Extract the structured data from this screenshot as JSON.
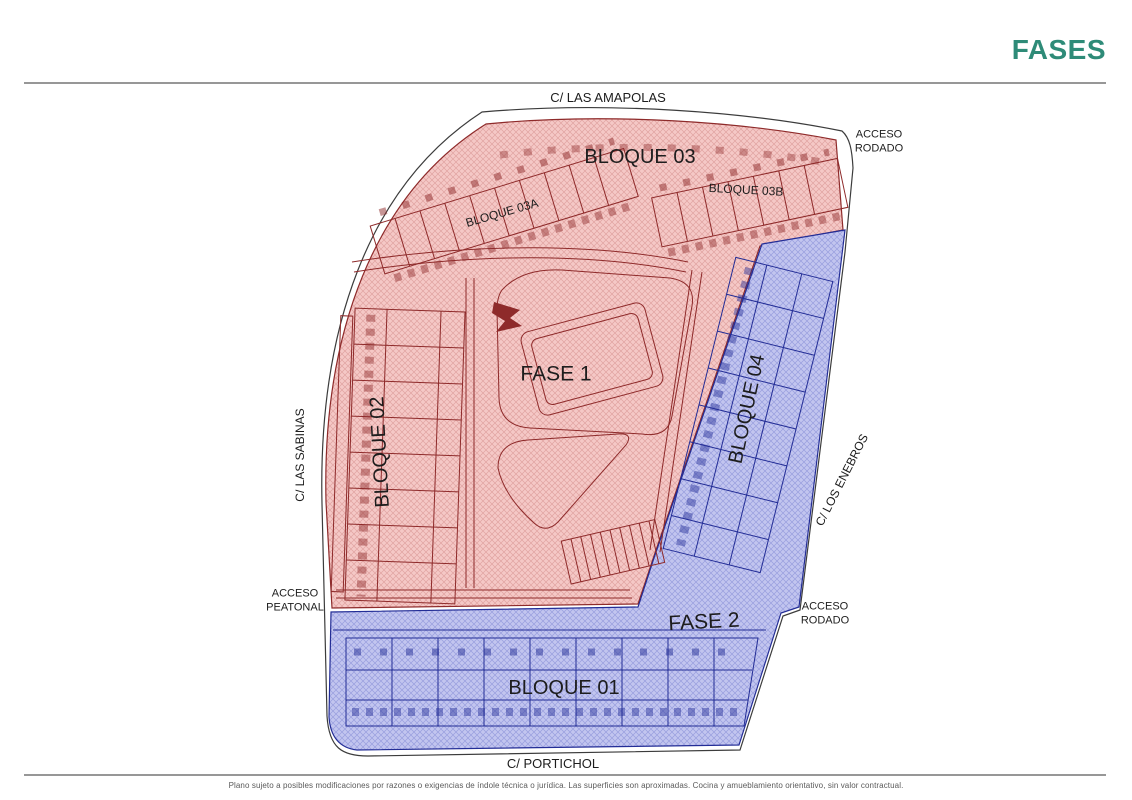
{
  "header": {
    "title": "FASES",
    "title_color": "#2e8b78"
  },
  "plan": {
    "streets": {
      "amapolas": "C/ LAS AMAPOLAS",
      "sabinas": "C/ LAS SABINAS",
      "enebros": "C/ LOS ENEBROS",
      "portichol": "C/ PORTICHOL"
    },
    "accesses": {
      "rodado_top": "ACCESO RODADO",
      "peatonal": "ACCESO PEATONAL",
      "rodado_bottom": "ACCESO RODADO"
    },
    "phases": {
      "fase1": {
        "label": "FASE 1",
        "fill": "#f5c8c6",
        "line": "#8e2a2a"
      },
      "fase2": {
        "label": "FASE 2",
        "fill": "#c2c5ef",
        "line": "#232d96"
      }
    },
    "blocks": {
      "b01": "BLOQUE 01",
      "b02": "BLOQUE 02",
      "b03": "BLOQUE 03",
      "b03a": "BLOQUE 03A",
      "b03b": "BLOQUE 03B",
      "b04": "BLOQUE 04"
    }
  },
  "footer": {
    "disclaimer": "Plano sujeto a posibles modificaciones por razones o exigencias de índole técnica o jurídica. Las superficies son aproximadas. Cocina y amueblamiento orientativo, sin valor contractual."
  }
}
